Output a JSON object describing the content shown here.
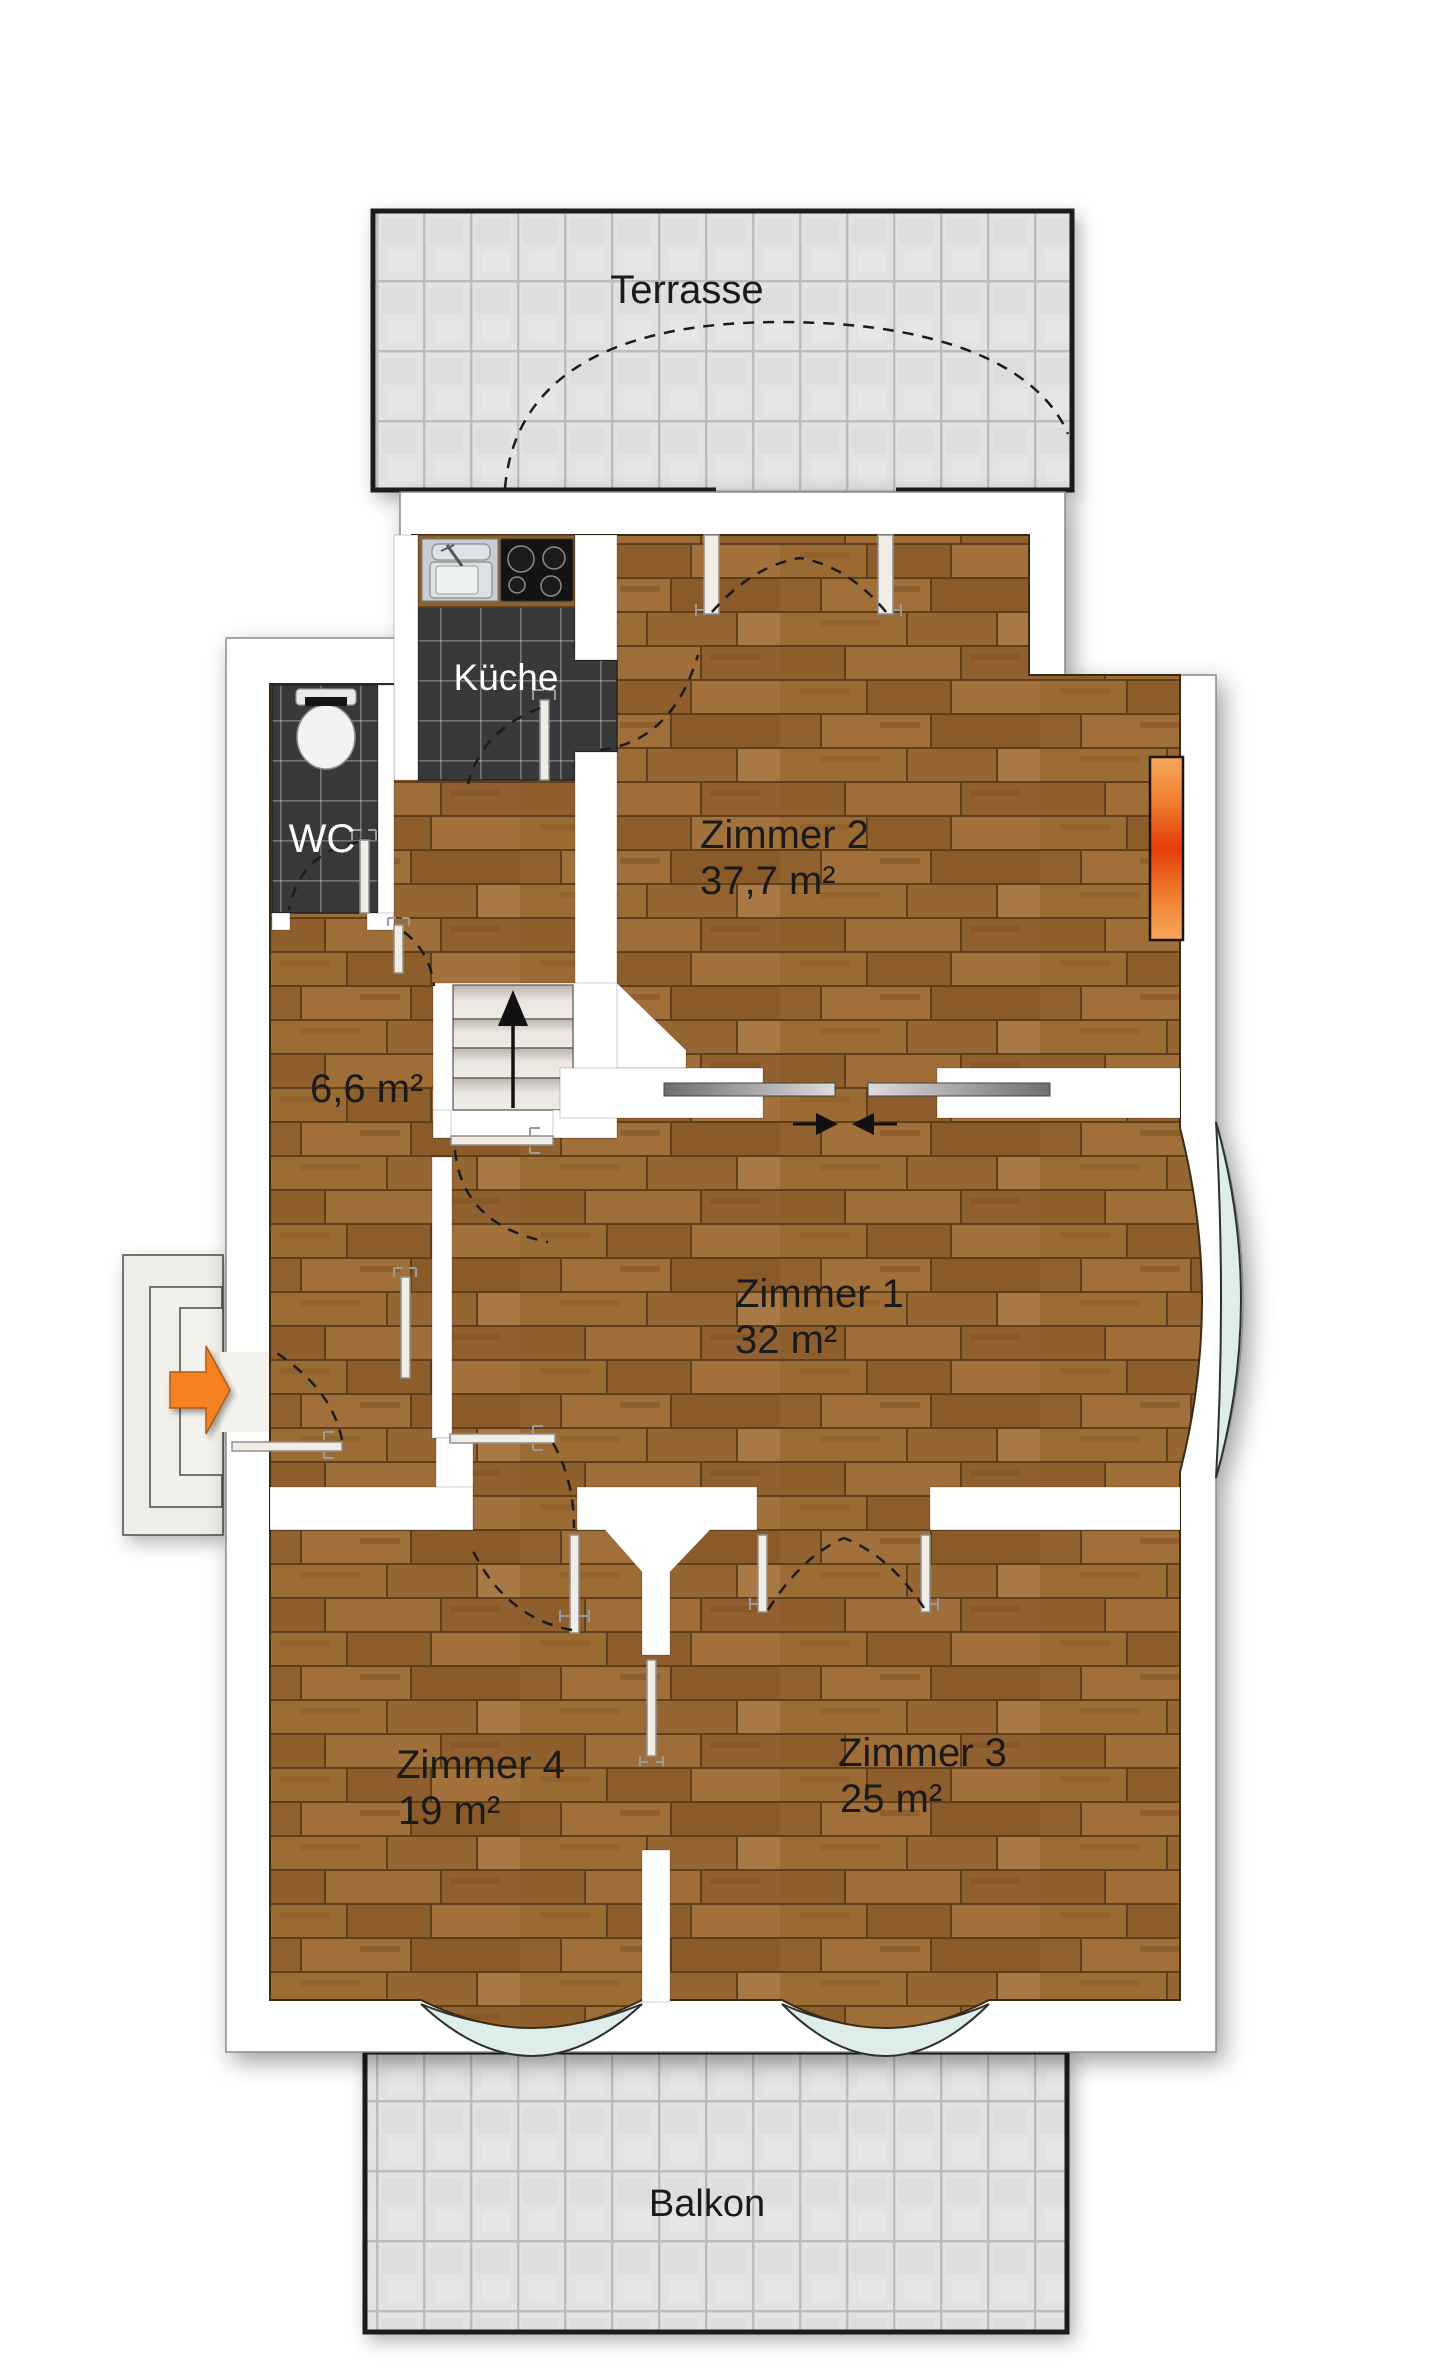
{
  "plan_title": "Wohnungsgrundriss Obergeschoss",
  "rooms": {
    "terrasse": {
      "label": "Terrasse"
    },
    "kueche": {
      "label": "Küche"
    },
    "wc": {
      "label": "WC"
    },
    "flur": {
      "area": "6,6 m²"
    },
    "zimmer1": {
      "label": "Zimmer 1",
      "area": "32 m²"
    },
    "zimmer2": {
      "label": "Zimmer 2",
      "area": "37,7 m²"
    },
    "zimmer3": {
      "label": "Zimmer 3",
      "area": "25 m²"
    },
    "zimmer4": {
      "label": "Zimmer 4",
      "area": "19 m²"
    },
    "balkon": {
      "label": "Balkon"
    }
  },
  "colors": {
    "wood_floor": "#9a6a33",
    "dark_tile": "#39393b",
    "light_tile": "#e2e2e2",
    "window_glass": "#ddeeea",
    "radiator_hot": "#e43c0a",
    "radiator_warm": "#f08432",
    "entrance_arrow": "#f58220",
    "wall": "#ffffff",
    "outline": "#2f2f2f"
  },
  "icons": {
    "entrance_arrow": "arrow-right",
    "stairs_direction": "arrow-up"
  }
}
